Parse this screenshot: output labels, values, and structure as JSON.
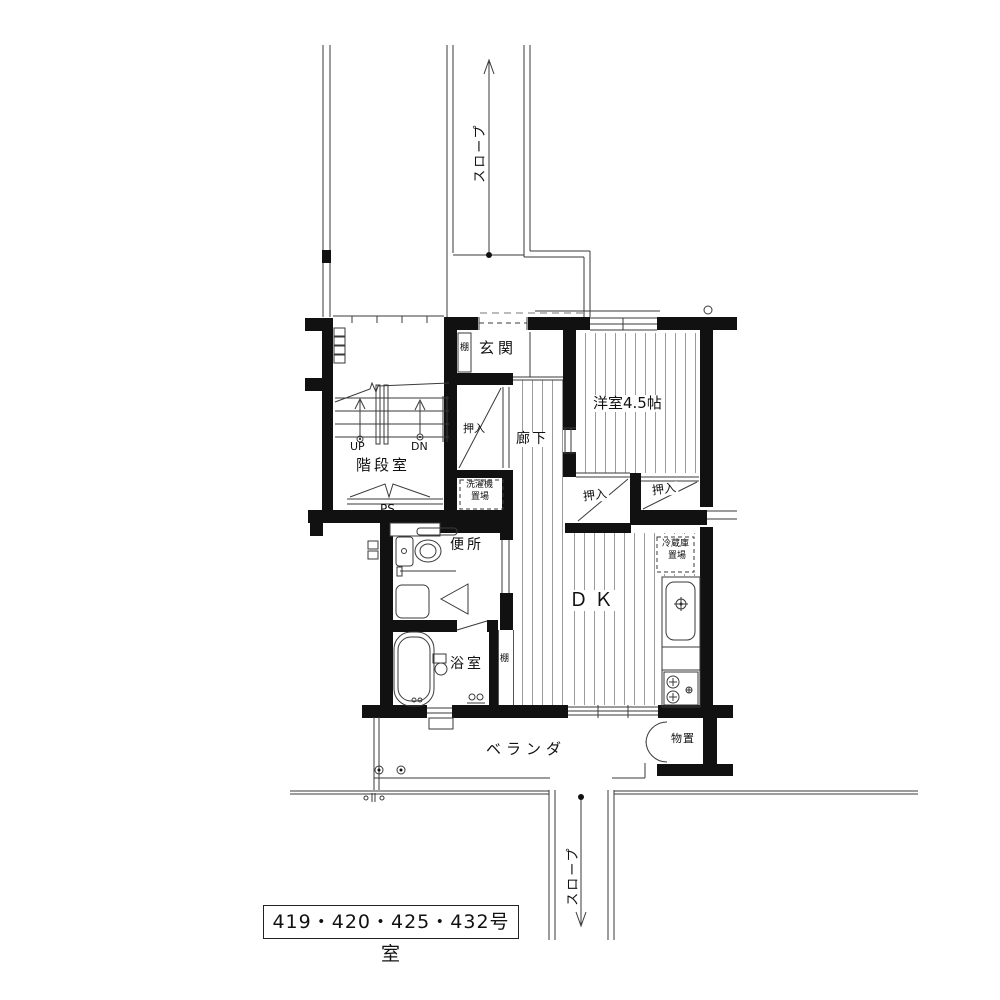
{
  "plan": {
    "title": "apartment-floor-plan",
    "rooms": {
      "genkan": "玄関",
      "stairwell": "階段室",
      "western_room": "洋室4.5帖",
      "hallway": "廊下",
      "toilet": "便所",
      "bathroom": "浴室",
      "dining_kitchen": "ＤＫ",
      "veranda": "ベランダ",
      "storage": "物置"
    },
    "closets": {
      "hall_closet": "押入",
      "closet_left": "押入",
      "closet_right": "押入"
    },
    "annotations": {
      "slope_top": "スロープ",
      "slope_bottom": "スロープ",
      "up": "UP",
      "down": "DN",
      "pipe_space": "PS",
      "shelf_genkan": "棚",
      "shelf_bath": "棚",
      "laundry_line1": "洗濯機",
      "laundry_line2": "置場",
      "fridge_line1": "冷蔵庫",
      "fridge_line2": "置場"
    },
    "room_numbers": "419・420・425・432号室",
    "colors": {
      "wall": "#111111",
      "line": "#3a3a3a",
      "floor_stripe": "#9a9a9a"
    }
  }
}
